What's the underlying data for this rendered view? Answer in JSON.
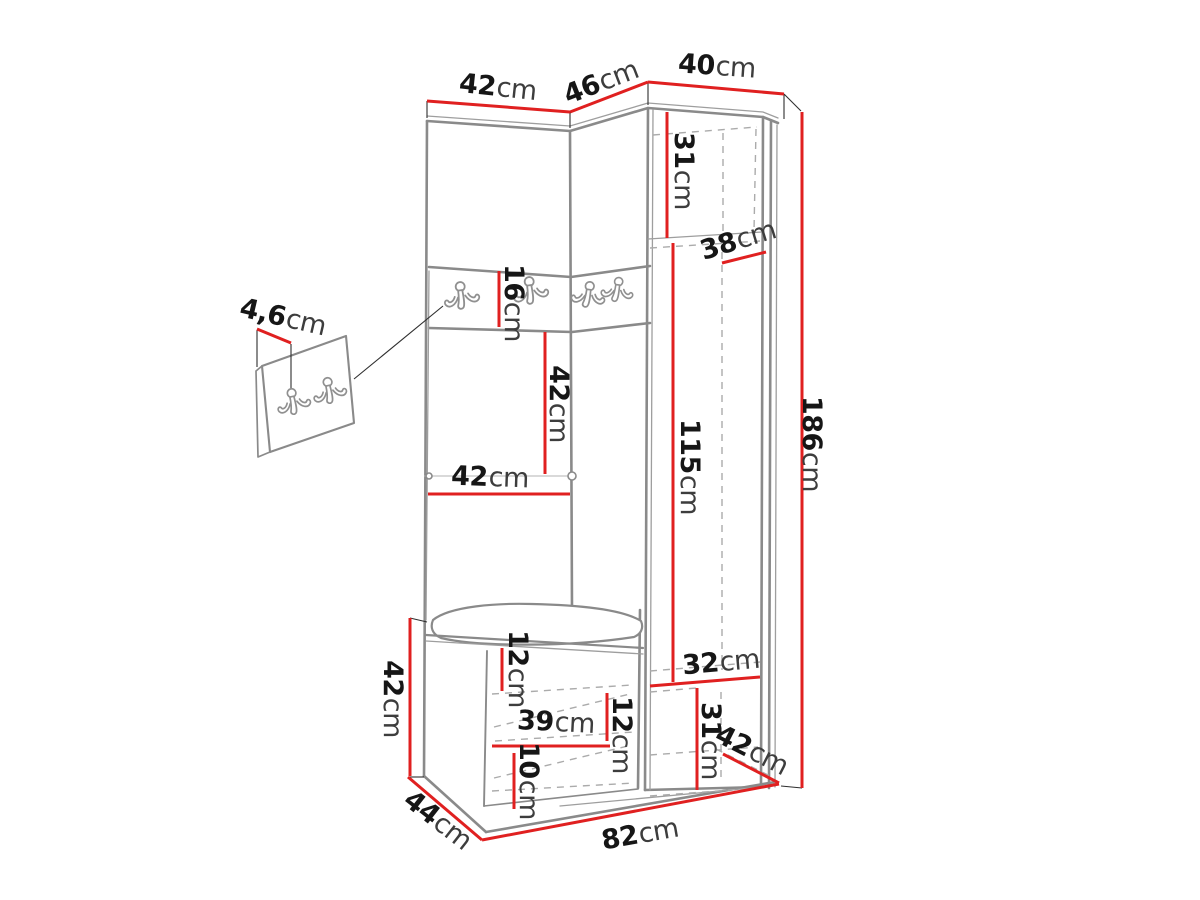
{
  "diagram": {
    "title": "Corner hallway wardrobe dimensional drawing",
    "unit_system": "cm",
    "colors": {
      "dimension_line": "#e02020",
      "outline": "#8a8a8a",
      "hidden_line": "#ababab",
      "text": "#161616",
      "background": "#ffffff"
    },
    "icons": {
      "coat_hook": "double wall coat hook",
      "hooks_on_unit": 4,
      "hooks_on_detail_panel": 2
    },
    "dimensions": [
      {
        "id": "top-width-left",
        "value": "42",
        "unit": "cm",
        "line": [
          427,
          101,
          570,
          112
        ],
        "label": {
          "x": 498,
          "y": 87,
          "rot": 6
        }
      },
      {
        "id": "top-width-corner",
        "value": "46",
        "unit": "cm",
        "line": [
          570,
          112,
          648,
          82
        ],
        "label": {
          "x": 601,
          "y": 82,
          "rot": -21
        }
      },
      {
        "id": "top-width-right",
        "value": "40",
        "unit": "cm",
        "line": [
          648,
          82,
          784,
          94
        ],
        "label": {
          "x": 717,
          "y": 66,
          "rot": 4
        }
      },
      {
        "id": "upper-right-height",
        "value": "31",
        "unit": "cm",
        "line": [
          667,
          112,
          667,
          238
        ],
        "label": {
          "x": 684,
          "y": 171,
          "rot": 90
        }
      },
      {
        "id": "shelf-depth",
        "value": "38",
        "unit": "cm",
        "line": [
          722,
          263,
          766,
          252
        ],
        "label": {
          "x": 738,
          "y": 240,
          "rot": -17
        }
      },
      {
        "id": "middle-right-height",
        "value": "115",
        "unit": "cm",
        "line": [
          673,
          243,
          673,
          682
        ],
        "label": {
          "x": 690,
          "y": 467,
          "rot": 90
        }
      },
      {
        "id": "total-height",
        "value": "186",
        "unit": "cm",
        "line": [
          802,
          112,
          802,
          788
        ],
        "label": {
          "x": 812,
          "y": 444,
          "rot": 90
        }
      },
      {
        "id": "hook-band-height",
        "value": "16",
        "unit": "cm",
        "line": [
          499,
          271,
          499,
          327
        ],
        "label": {
          "x": 514,
          "y": 303,
          "rot": 90
        }
      },
      {
        "id": "open-section-height",
        "value": "42",
        "unit": "cm",
        "line": [
          545,
          332,
          545,
          474
        ],
        "label": {
          "x": 559,
          "y": 404,
          "rot": 90
        }
      },
      {
        "id": "open-section-width",
        "value": "42",
        "unit": "cm",
        "line": [
          428,
          494,
          570,
          494
        ],
        "label": {
          "x": 490,
          "y": 477,
          "rot": 2
        }
      },
      {
        "id": "bench-height",
        "value": "42",
        "unit": "cm",
        "line": [
          410,
          618,
          410,
          776
        ],
        "label": {
          "x": 393,
          "y": 699,
          "rot": 90
        }
      },
      {
        "id": "bench-top-gap",
        "value": "12",
        "unit": "cm",
        "line": [
          502,
          648,
          502,
          691
        ],
        "label": {
          "x": 518,
          "y": 669,
          "rot": 90
        }
      },
      {
        "id": "bench-shelf-width",
        "value": "39",
        "unit": "cm",
        "line": [
          492,
          746,
          610,
          746
        ],
        "label": {
          "x": 556,
          "y": 722,
          "rot": 3
        }
      },
      {
        "id": "bench-right-gap",
        "value": "12",
        "unit": "cm",
        "line": [
          607,
          693,
          607,
          741
        ],
        "label": {
          "x": 622,
          "y": 735,
          "rot": 90
        }
      },
      {
        "id": "bench-bottom-gap",
        "value": "10",
        "unit": "cm",
        "line": [
          514,
          753,
          514,
          809
        ],
        "label": {
          "x": 529,
          "y": 781,
          "rot": 90
        }
      },
      {
        "id": "lower-right-width",
        "value": "32",
        "unit": "cm",
        "line": [
          650,
          686,
          760,
          677
        ],
        "label": {
          "x": 721,
          "y": 662,
          "rot": -5
        }
      },
      {
        "id": "lower-right-height",
        "value": "31",
        "unit": "cm",
        "line": [
          697,
          688,
          697,
          790
        ],
        "label": {
          "x": 711,
          "y": 741,
          "rot": 90
        }
      },
      {
        "id": "lower-right-depth",
        "value": "42",
        "unit": "cm",
        "line": [
          723,
          754,
          779,
          783
        ],
        "label": {
          "x": 752,
          "y": 750,
          "rot": 27
        }
      },
      {
        "id": "bench-depth",
        "value": "44",
        "unit": "cm",
        "line": [
          408,
          777,
          482,
          840
        ],
        "label": {
          "x": 438,
          "y": 820,
          "rot": 38
        }
      },
      {
        "id": "bottom-width",
        "value": "82",
        "unit": "cm",
        "line": [
          482,
          840,
          779,
          784
        ],
        "label": {
          "x": 640,
          "y": 834,
          "rot": -10
        }
      },
      {
        "id": "panel-thickness",
        "value": "4,6",
        "unit": "cm",
        "line": [
          257,
          329,
          291,
          343
        ],
        "label": {
          "x": 283,
          "y": 317,
          "rot": 13
        }
      }
    ]
  }
}
